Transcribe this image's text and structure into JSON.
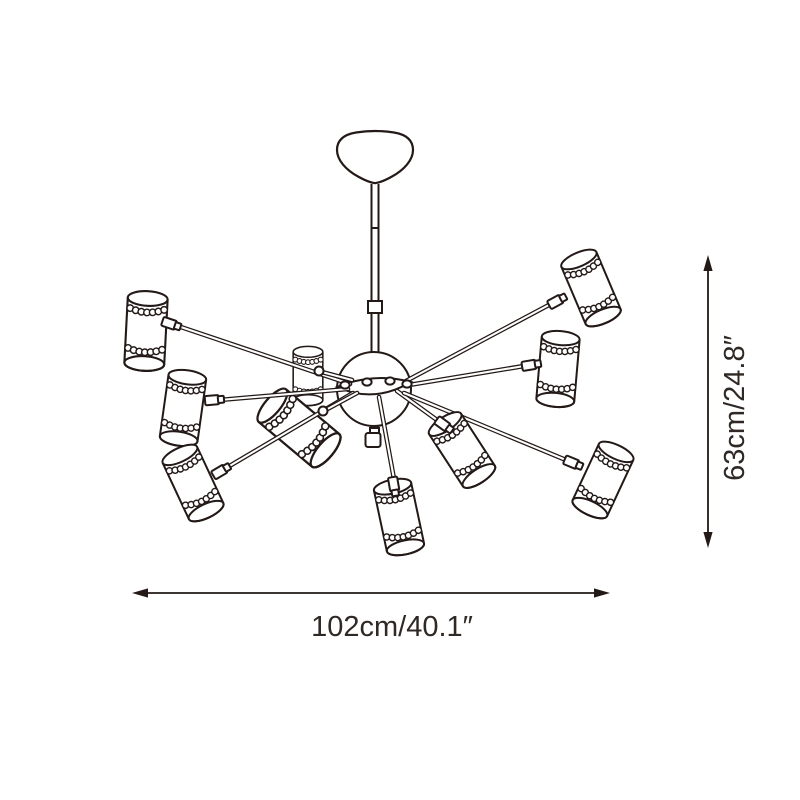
{
  "dimensions": {
    "width_label": "102cm/40.1″",
    "height_label": "63cm/24.8″"
  },
  "product": {
    "shade_count": 10,
    "arm_count": 10
  },
  "colors": {
    "line": "#231916",
    "dimension_text": "#2f2824",
    "background": "#ffffff"
  }
}
